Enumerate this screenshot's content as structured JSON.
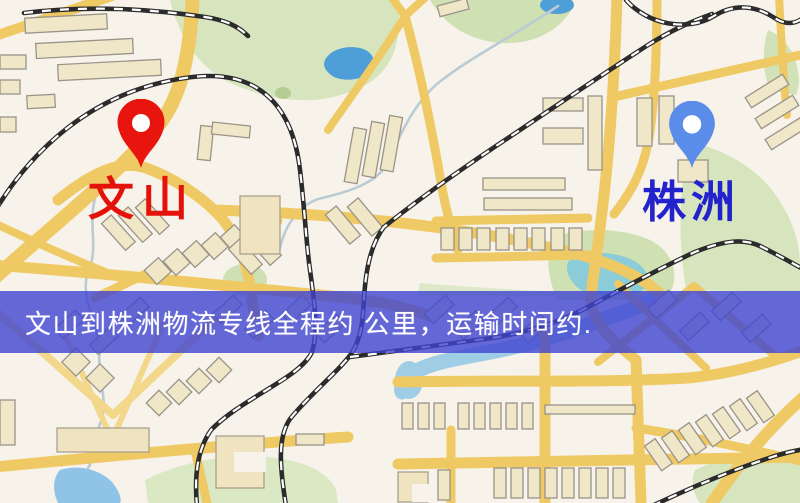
{
  "map_image": {
    "markers": {
      "origin": {
        "name": "文山",
        "pin_color": "#e8150e",
        "label_color": "#e3120b"
      },
      "destination": {
        "name": "株洲",
        "pin_color": "#5a8cea",
        "label_color": "#2323cd"
      }
    },
    "banner": {
      "text": "文山到株洲物流专线全程约 公里，运输时间约.",
      "background": "#3e43d1",
      "opacity": "0.8",
      "text_color": "#ffffff"
    },
    "palette": {
      "background": "#f7f2ea",
      "road": "#efc963",
      "building": "#f0e6c8",
      "park_green": "#d6e5bd",
      "lake_blue": "#4e9ed8",
      "pond_teal": "#8ccbd8",
      "railway": "#2b2b2b"
    }
  }
}
